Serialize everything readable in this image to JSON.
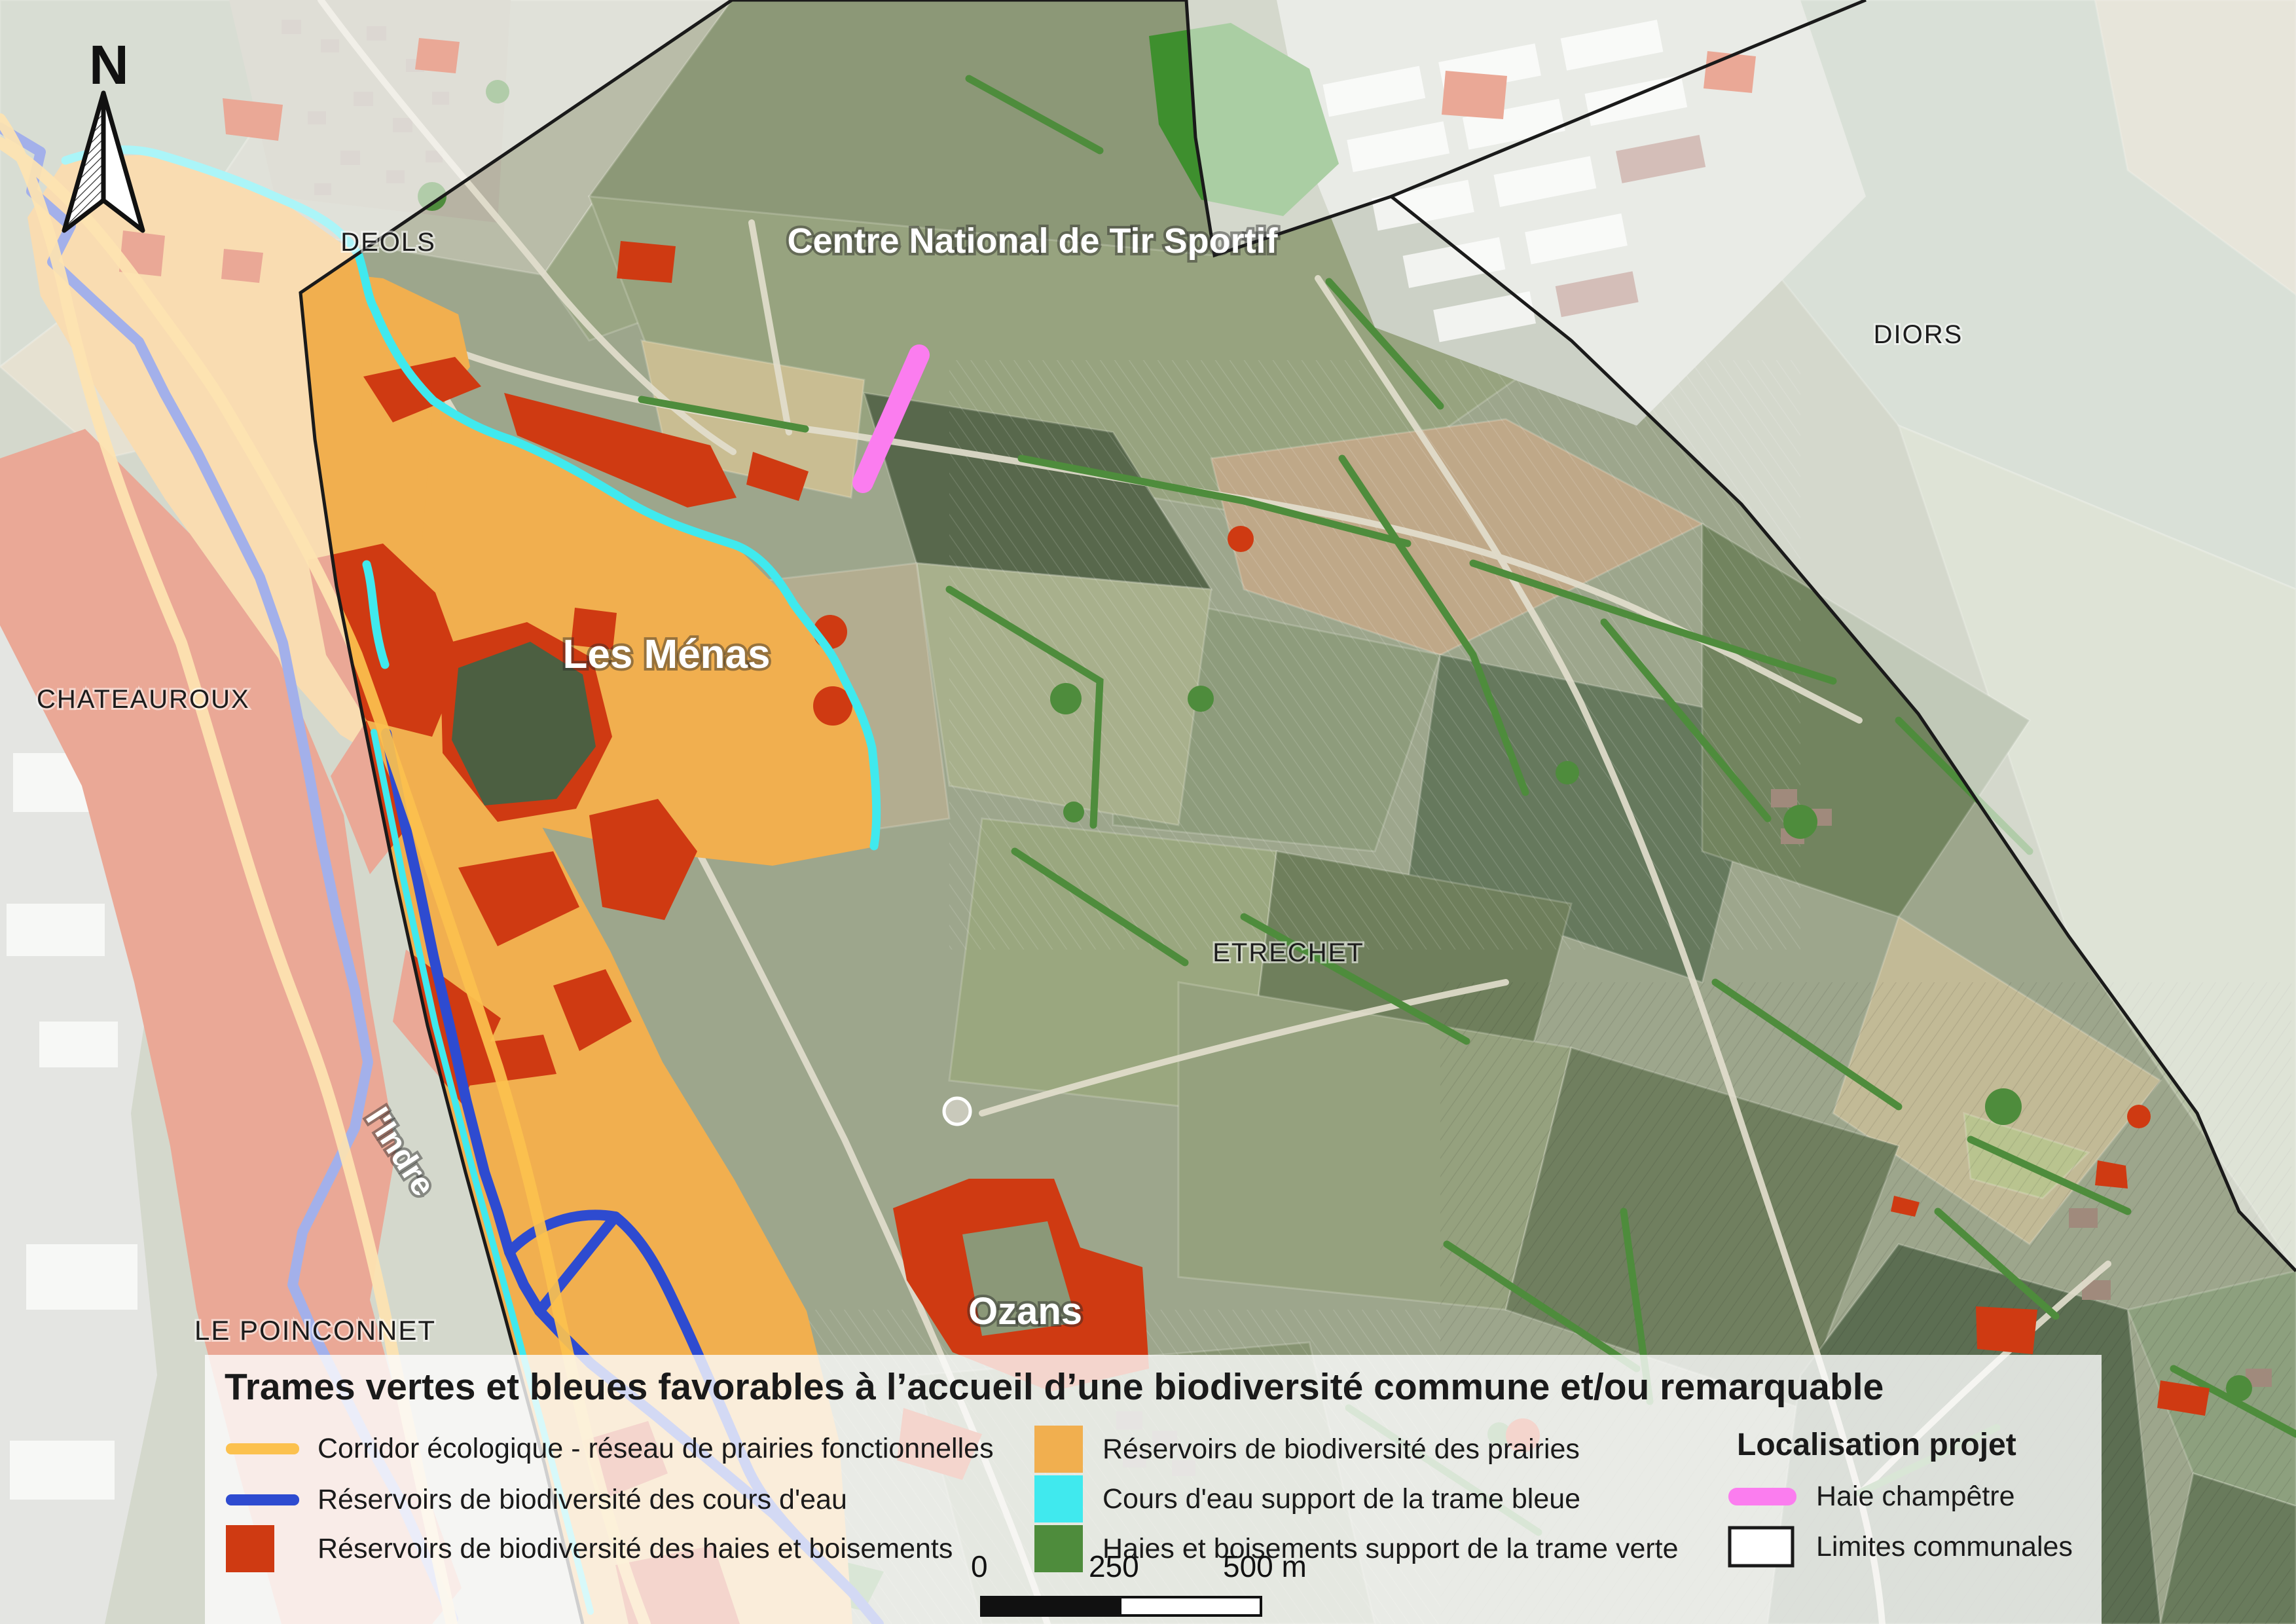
{
  "colors": {
    "corridor": "#FCC14E",
    "cours_eau": "#2E4BD0",
    "haies_boisements": "#CF3A12",
    "prairies": "#F1AF4F",
    "trame_bleue": "#40E9EE",
    "trame_verte": "#4E8C3C",
    "haie_champetre": "#FB7DEF",
    "limites": "#1A1A1A"
  },
  "north_label": "N",
  "places": {
    "deols": "DEOLS",
    "diors": "DIORS",
    "chateauroux": "CHATEAUROUX",
    "le_poinconnet": "LE POINCONNET",
    "etrechet": "ETRECHET",
    "les_menas": "Les Ménas",
    "ozans": "Ozans",
    "centre_tir": "Centre National de Tir Sportif",
    "indre": "l'Indre"
  },
  "legend": {
    "title": "Trames vertes et bleues favorables à l’accueil d’une biodiversité commune et/ou remarquable",
    "col1": {
      "corridor": "Corridor écologique - réseau de prairies fonctionnelles",
      "cours_eau": "Réservoirs de biodiversité des cours d'eau",
      "haies": "Réservoirs de biodiversité des haies et boisements"
    },
    "col2": {
      "prairies": "Réservoirs de biodiversité des prairies",
      "trame_bleue": "Cours d'eau support de la trame bleue",
      "trame_verte": "Haies et boisements support de la trame verte"
    },
    "project": {
      "title": "Localisation projet",
      "haie": "Haie champêtre",
      "limites": "Limites communales"
    }
  },
  "scalebar": {
    "start": "0",
    "mid": "250",
    "end": "500 m"
  }
}
